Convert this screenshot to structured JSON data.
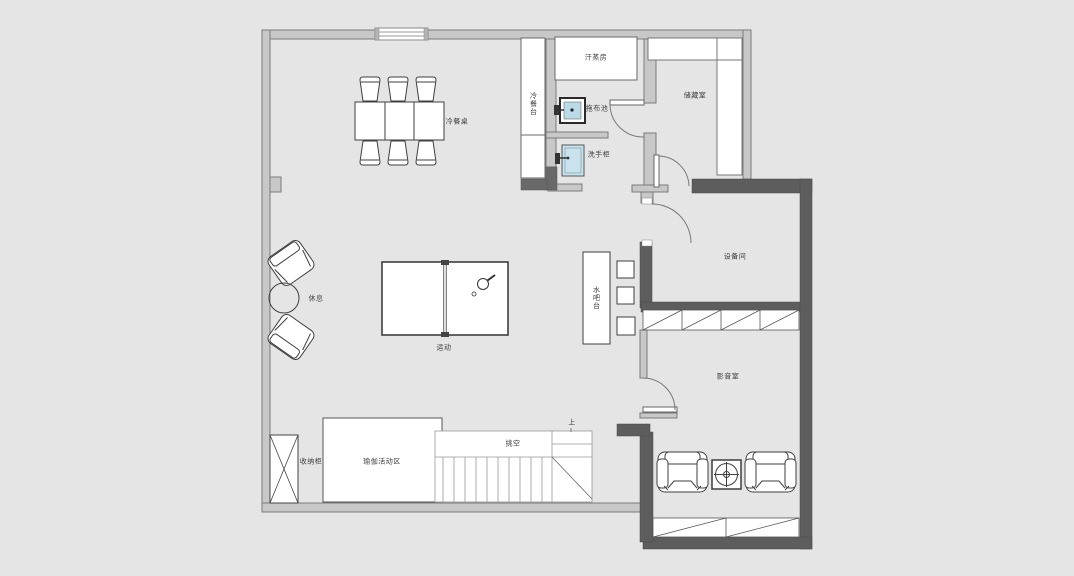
{
  "plan": {
    "title": "basement-floor-plan",
    "labels": {
      "dining_table": "冷餐桌",
      "cold_buffet_counter": "冷餐台",
      "sauna_room": "汗蒸房",
      "mop_sink": "拖布池",
      "wash_cabinet": "洗手柜",
      "storage_room": "储藏室",
      "equipment_room": "设备间",
      "rest_area": "休息",
      "sport_area": "运动",
      "water_bar": "水吧台",
      "av_room": "影音室",
      "storage_cabinet": "收纳柜",
      "yoga_area": "瑜伽活动区",
      "void_space": "挑空",
      "stairs_up": "上"
    },
    "colors": {
      "background": "#e5e5e5",
      "wall_light": "#c8c8c8",
      "wall_dark": "#5d5d5d",
      "fixture_blue": "#b9dbe7",
      "line": "#444444",
      "room_fill": "#ffffff"
    }
  }
}
